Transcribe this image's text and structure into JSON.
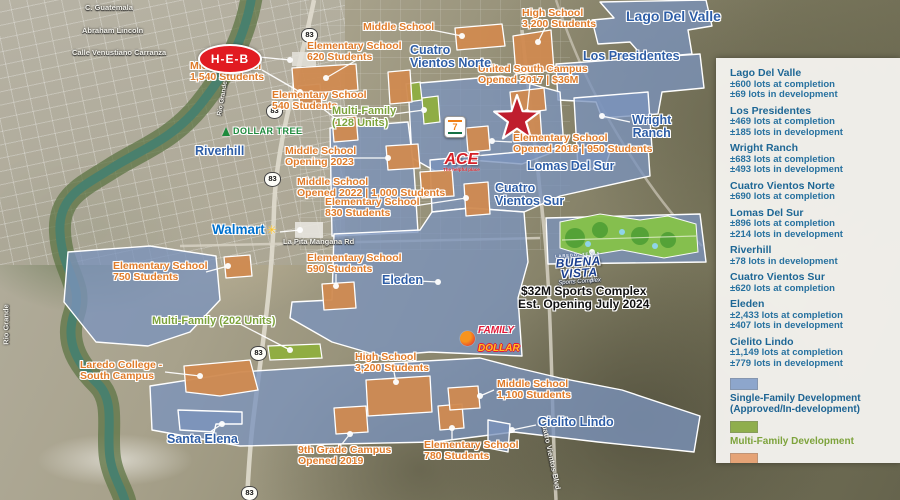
{
  "colors": {
    "single_family": "#8da6cc",
    "multi_family": "#8fae4d",
    "educational": "#e5a376",
    "school_label": "#e07c2a",
    "development_label": "#2e5ea7",
    "panel_text": "#1e6795",
    "star": "#bf1e2e"
  },
  "panel": {
    "developments": [
      {
        "name": "Lago Del Valle",
        "lines": [
          "±600 lots at completion",
          "±69 lots in development"
        ]
      },
      {
        "name": "Los Presidentes",
        "lines": [
          "±469 lots at completion",
          "±185 lots in development"
        ]
      },
      {
        "name": "Wright Ranch",
        "lines": [
          "±683 lots at completion",
          "±493 lots in development"
        ]
      },
      {
        "name": "Cuatro Vientos Norte",
        "lines": [
          "±690 lots at completion"
        ]
      },
      {
        "name": "Lomas Del Sur",
        "lines": [
          "±896 lots at completion",
          "±214 lots in development"
        ]
      },
      {
        "name": "Riverhill",
        "lines": [
          "±78 lots in development"
        ]
      },
      {
        "name": "Cuatro Vientos Sur",
        "lines": [
          "±620 lots at completion"
        ]
      },
      {
        "name": "Eleden",
        "lines": [
          "±2,433 lots at completion",
          "±407 lots in development"
        ]
      },
      {
        "name": "Cielito Lindo",
        "lines": [
          "±1,149 lots at completion",
          "±779 lots in development"
        ]
      }
    ],
    "legend": [
      {
        "l1": "Single-Family Development",
        "l2": "(Approved/In-development)"
      },
      {
        "l1": "Multi-Family Development",
        "l2": ""
      },
      {
        "l1": "Educational/University",
        "l2": ""
      }
    ]
  },
  "map": {
    "highway_shield": "83",
    "streets": {
      "guatemala": "C. Guatemala",
      "lincoln": "Abraham Lincoln",
      "carranza": "Calle Venustiano Carranza",
      "la_pita": "La Pita Mangana Rd",
      "rio_grande": "Rio Grande",
      "rio_grande2": "Rio Grande",
      "cv_blvd": "Cuatro Vientos Blvd"
    },
    "schools": {
      "ms1540": {
        "l1": "Middle School",
        "l2": "1,540 Students"
      },
      "es620": {
        "l1": "Elementary School",
        "l2": "620 Students"
      },
      "ms_top": {
        "l1": "Middle School"
      },
      "hs3200_top": {
        "l1": "High School",
        "l2": "3,200 Students"
      },
      "usc": {
        "l1": "United South Campus",
        "l2": "Opened 2017 | $36M"
      },
      "es540": {
        "l1": "Elementary School",
        "l2": "540 Students"
      },
      "ms2023": {
        "l1": "Middle School",
        "l2": "Opening 2023"
      },
      "ms2022": {
        "l1": "Middle School",
        "l2": "Opened 2022 | 1,000 Students"
      },
      "es830": {
        "l1": "Elementary School",
        "l2": "830 Students"
      },
      "es2018": {
        "l1": "Elementary School",
        "l2": "Opened 2018 | 950 Students"
      },
      "es750": {
        "l1": "Elementary School",
        "l2": "750 Students"
      },
      "es590": {
        "l1": "Elementary School",
        "l2": "590 Students"
      },
      "laredo_college": {
        "l1": "Laredo College -",
        "l2": "South Campus"
      },
      "hs3200_bottom": {
        "l1": "High School",
        "l2": "3,200 Students"
      },
      "grade9": {
        "l1": "9th Grade Campus",
        "l2": "Opened 2019"
      },
      "es780": {
        "l1": "Elementary School",
        "l2": "780 Students"
      },
      "ms1100": {
        "l1": "Middle School",
        "l2": "1,100 Students"
      }
    },
    "multifamily": {
      "mf128": {
        "l1": "Multi-Family",
        "l2": "(128 Units)"
      },
      "mf202": {
        "l1": "Multi-Family (202 Units)"
      }
    },
    "developments": {
      "lago": {
        "l1": "Lago Del Valle"
      },
      "presidentes": {
        "l1": "Los Presidentes"
      },
      "wright": {
        "l1": "Wright",
        "l2": "Ranch"
      },
      "cvn": {
        "l1": "Cuatro",
        "l2": "Vientos Norte"
      },
      "lomas": {
        "l1": "Lomas Del Sur"
      },
      "cvs": {
        "l1": "Cuatro",
        "l2": "Vientos Sur"
      },
      "riverhill": {
        "l1": "Riverhill"
      },
      "eleden": {
        "l1": "Eleden"
      },
      "santa_elena": {
        "l1": "Santa Elena"
      },
      "cielito": {
        "l1": "Cielito Lindo"
      }
    },
    "sports": {
      "l1": "$32M Sports Complex",
      "l2": "Est. Opening July 2024"
    },
    "logos": {
      "heb": "H-E-B",
      "dollar_tree": "DOLLAR TREE",
      "walmart": "Walmart",
      "walmart_spark": "✳",
      "ace": "ACE",
      "ace_tag": "The helpful place",
      "seven_eleven": "7",
      "family_dollar_1": "FAMILY",
      "family_dollar_2": "DOLLAR",
      "bv_top": "LAREDO, TEXAS",
      "bv_1": "BUENA",
      "bv_2": "VISTA",
      "bv_script": "Sports Complex"
    }
  }
}
